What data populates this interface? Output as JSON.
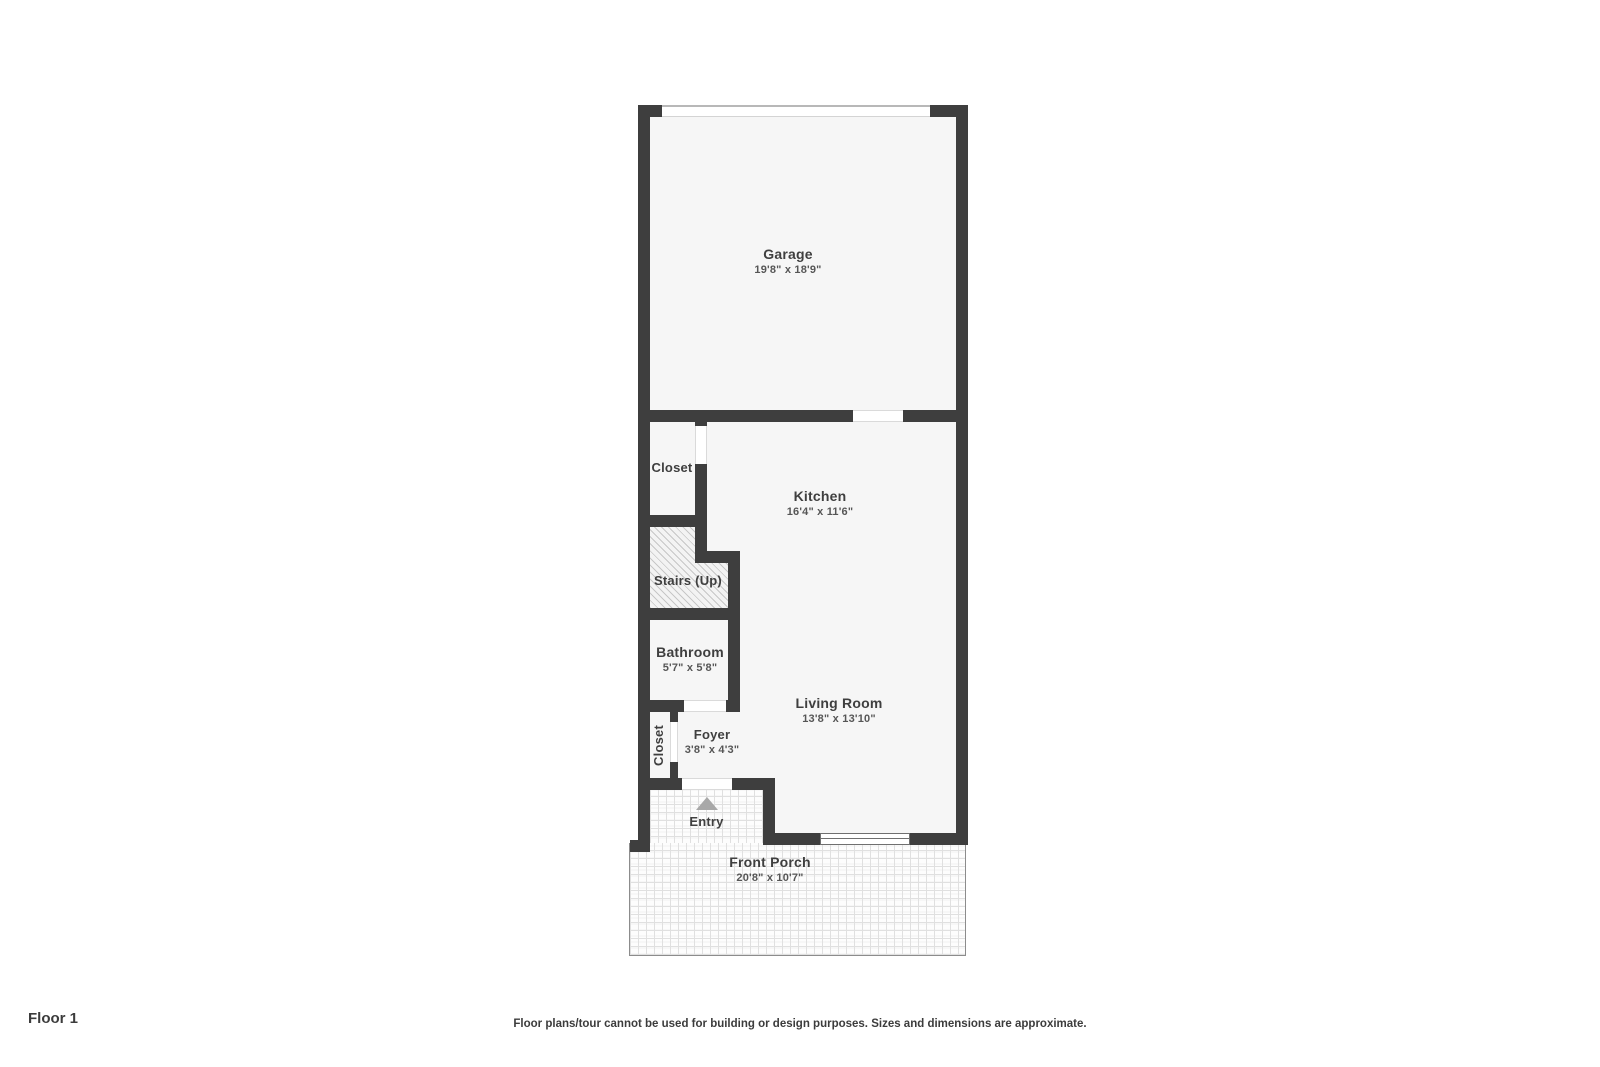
{
  "colors": {
    "wall": "#3e3e3e",
    "room_fill": "#f6f6f6",
    "label_text": "#3f3f3f",
    "entry_arrow": "#a8a8a8",
    "paver_line": "#e0e0e0",
    "hatch_line": "#c7c7c7"
  },
  "floor_plan": {
    "rooms": {
      "garage": {
        "name": "Garage",
        "dims": "19'8\" x 18'9\""
      },
      "closet_upper": {
        "name": "Closet"
      },
      "kitchen": {
        "name": "Kitchen",
        "dims": "16'4\" x 11'6\""
      },
      "stairs": {
        "name": "Stairs (Up)"
      },
      "bathroom": {
        "name": "Bathroom",
        "dims": "5'7\" x 5'8\""
      },
      "closet_lower": {
        "name": "Closet"
      },
      "foyer": {
        "name": "Foyer",
        "dims": "3'8\" x 4'3\""
      },
      "entry": {
        "name": "Entry"
      },
      "living_room": {
        "name": "Living Room",
        "dims": "13'8\" x 13'10\""
      },
      "front_porch": {
        "name": "Front Porch",
        "dims": "20'8\" x 10'7\""
      }
    }
  },
  "footer": {
    "floor_label": "Floor 1",
    "disclaimer": "Floor plans/tour cannot be used for building or design purposes. Sizes and dimensions are approximate."
  }
}
